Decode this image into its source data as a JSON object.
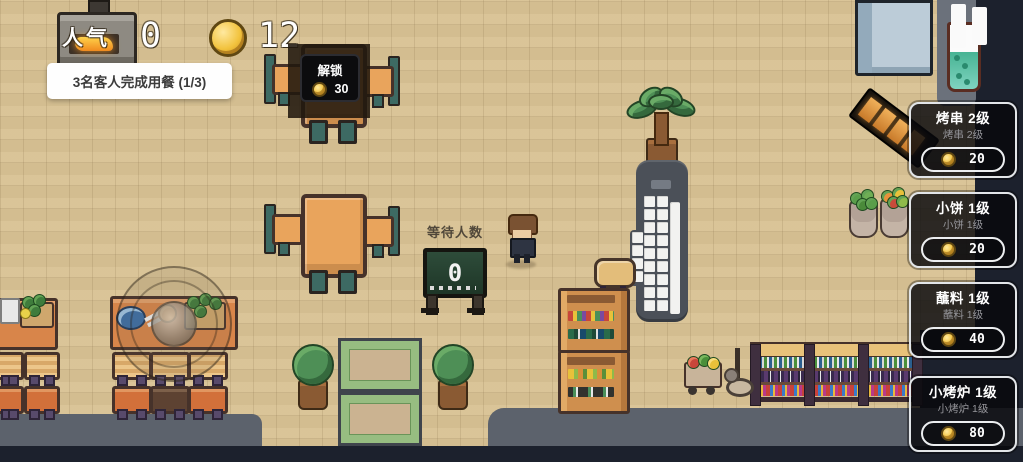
{
  "hud": {
    "popularity": {
      "label": "人气",
      "value": "0"
    },
    "coins": {
      "value": "12"
    },
    "toast": "3名客人完成用餐 (1/3)"
  },
  "unlock_overlay": {
    "label": "解锁",
    "cost": "30"
  },
  "waiting_board": {
    "label": "等待人数",
    "count": "0"
  },
  "shop_cards": [
    {
      "title": "烤串 2级",
      "subtitle": "烤串 2级",
      "cost": "20"
    },
    {
      "title": "小饼 1级",
      "subtitle": "小饼 1级",
      "cost": "20"
    },
    {
      "title": "蘸料 1级",
      "subtitle": "蘸料 1级",
      "cost": "40"
    },
    {
      "title": "小烤炉 1级",
      "subtitle": "小烤炉 1级",
      "cost": "80"
    }
  ],
  "icons": {
    "coin": "coin-icon",
    "pause": "pause-icon",
    "joystick": "joystick"
  },
  "colors": {
    "floor": "#d8c294",
    "road": "#5c626c",
    "night": "#1c212d",
    "coin_gold": "#f2c33e",
    "card_border": "#e2e5e8",
    "board_green": "#2e4c3a",
    "toast_bg": "#fefefe"
  }
}
